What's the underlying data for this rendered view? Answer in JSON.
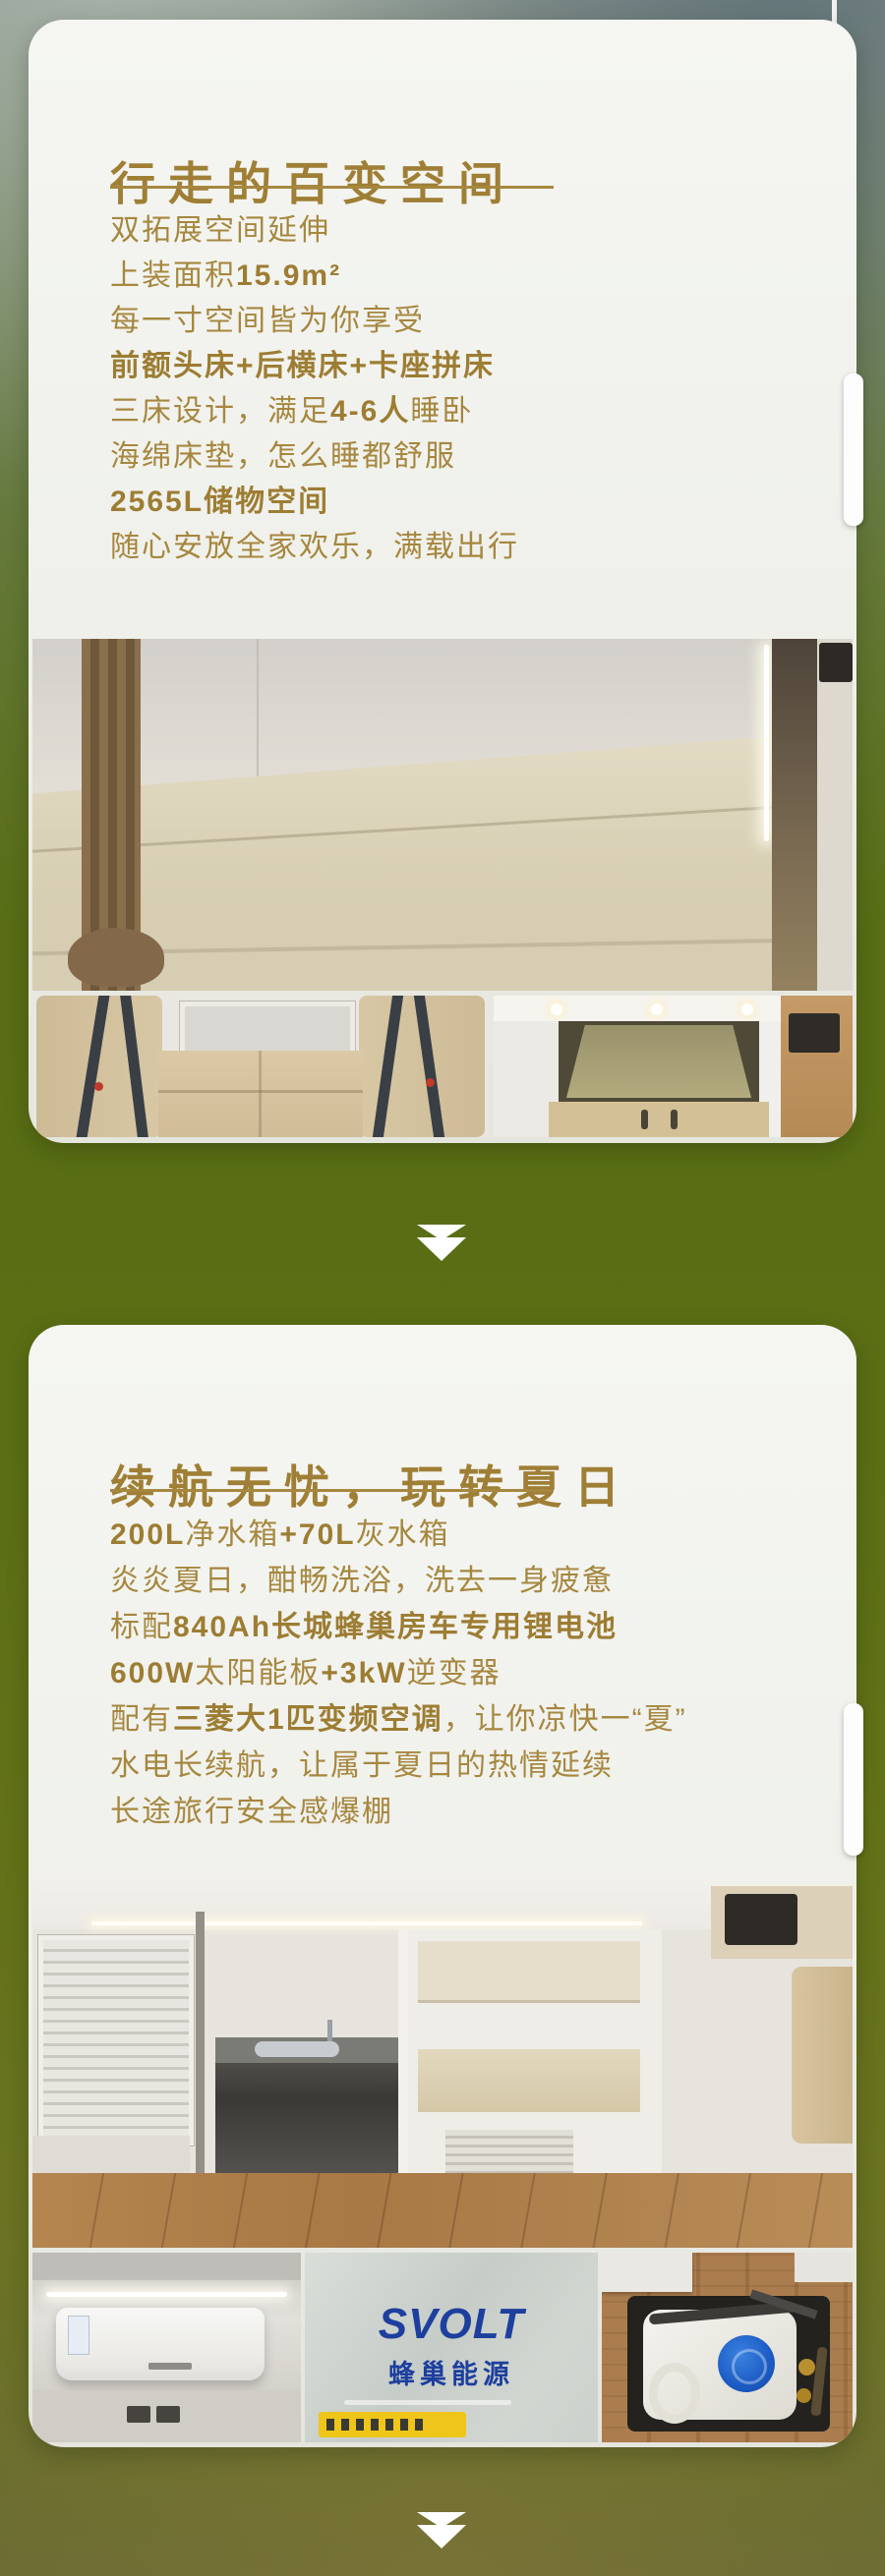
{
  "colors": {
    "accent_gold": "#a6873f",
    "title_gold": "#9f7f35",
    "card_bg": "#f3f4ef",
    "page_olive": "#5e7018",
    "arrow_white": "#ffffff",
    "svolt_blue": "#1d3f9e",
    "svolt_yellow": "#efc51a"
  },
  "card1": {
    "title": "行走的百变空间",
    "lines": [
      [
        {
          "text": "双拓展空间延伸",
          "bold": false
        }
      ],
      [
        {
          "text": "上装面积",
          "bold": false
        },
        {
          "text": "15.9m²",
          "bold": true
        }
      ],
      [
        {
          "text": "每一寸空间皆为你享受",
          "bold": false
        }
      ],
      [
        {
          "text": "前额头床+后横床+卡座拼床",
          "bold": true
        }
      ],
      [
        {
          "text": "三床设计，满足",
          "bold": false
        },
        {
          "text": "4-6人",
          "bold": true
        },
        {
          "text": "睡卧",
          "bold": false
        }
      ],
      [
        {
          "text": "海绵床垫，怎么睡都舒服",
          "bold": false
        }
      ],
      [
        {
          "text": "2565L储物空间",
          "bold": true
        }
      ],
      [
        {
          "text": "随心安放全家欢乐，满载出行",
          "bold": false
        }
      ]
    ]
  },
  "card2": {
    "title": "续航无忧，玩转夏日",
    "lines": [
      [
        {
          "text": "200L",
          "bold": true
        },
        {
          "text": "净水箱",
          "bold": false
        },
        {
          "text": "+70L",
          "bold": true
        },
        {
          "text": "灰水箱",
          "bold": false
        }
      ],
      [
        {
          "text": "炎炎夏日，酣畅洗浴，洗去一身疲惫",
          "bold": false
        }
      ],
      [
        {
          "text": "标配",
          "bold": false
        },
        {
          "text": "840Ah长城蜂巢房车专用锂电池",
          "bold": true
        }
      ],
      [
        {
          "text": "600W",
          "bold": true
        },
        {
          "text": "太阳能板",
          "bold": false
        },
        {
          "text": "+3kW",
          "bold": true
        },
        {
          "text": "逆变器",
          "bold": false
        }
      ],
      [
        {
          "text": "配有",
          "bold": false
        },
        {
          "text": "三菱大1匹变频空调",
          "bold": true
        },
        {
          "text": "，让你凉快一“夏”",
          "bold": false
        }
      ],
      [
        {
          "text": "水电长续航，让属于夏日的热情延续",
          "bold": false
        }
      ],
      [
        {
          "text": "长途旅行安全感爆棚",
          "bold": false
        }
      ]
    ],
    "battery_brand": {
      "en": "SVOLT",
      "cn": "蜂巢能源"
    }
  },
  "icons": {
    "down_arrow": "double-down-arrow"
  }
}
